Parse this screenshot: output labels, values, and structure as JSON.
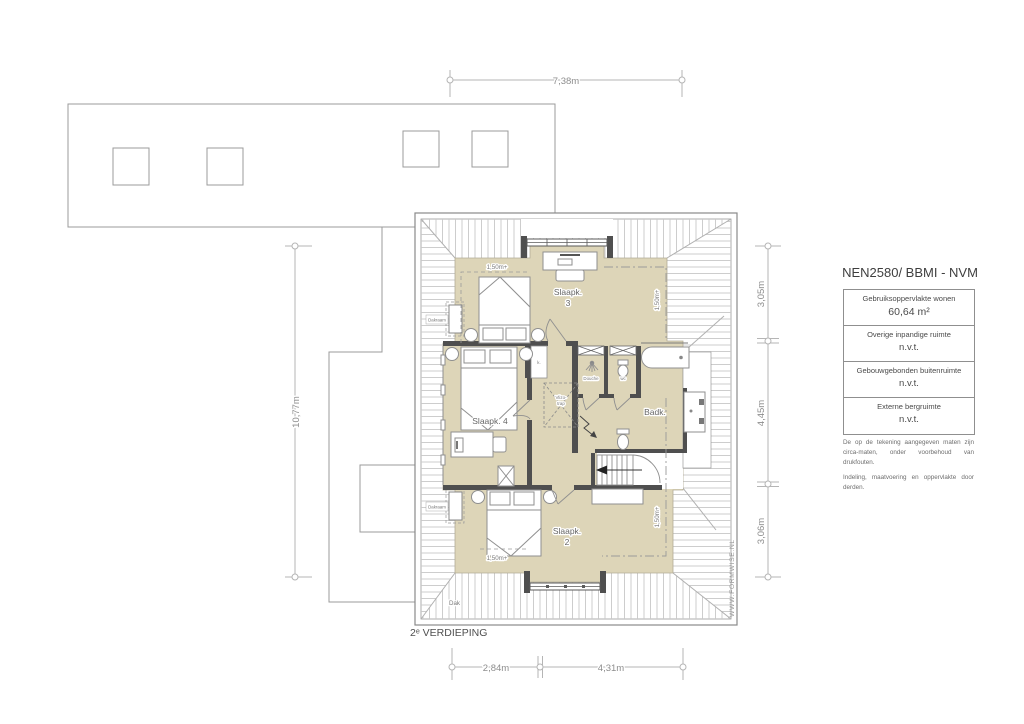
{
  "plan": {
    "floor_label": "2ᵉ VERDIEPING",
    "watermark": "WWW.FORMWISE.NL",
    "rooms": {
      "slaapk3": {
        "line1": "Slaapk.",
        "line2": "3"
      },
      "slaapk4": "Slaapk. 4",
      "slaapk2": {
        "line1": "Slaapk.",
        "line2": "2"
      },
      "badkamer": "Badk.",
      "douche": "Douche",
      "wc": "wc",
      "kast": "k.",
      "vlizotrap": {
        "line1": "Vlizo-",
        "line2": "trap"
      },
      "dak": "Dak",
      "dakraam_top": "Dakraam",
      "dakraam_bottom": "Dakraam"
    },
    "headroom": {
      "slaapk3": "1,50m+",
      "slaapk2": "1,50m+",
      "right_top": "1,50m+",
      "right_bottom": "1,50m+"
    }
  },
  "dimensions": {
    "top_width": "7,38m",
    "left_height": "10,77m",
    "right": {
      "top": "3,05m",
      "middle": "4,45m",
      "bottom": "3,06m"
    },
    "bottom": {
      "left": "2,84m",
      "right": "4,31m"
    }
  },
  "legend": {
    "title": "NEN2580/ BBMI - NVM",
    "rows": [
      {
        "label": "Gebruiksoppervlakte wonen",
        "value": "60,64 m²"
      },
      {
        "label": "Overige inpandige ruimte",
        "value": "n.v.t."
      },
      {
        "label": "Gebouwgebonden buitenruimte",
        "value": "n.v.t."
      },
      {
        "label": "Externe bergruimte",
        "value": "n.v.t."
      }
    ],
    "disclaimer_1": "De op de tekening aangegeven maten zijn circa-maten, onder voorbehoud van drukfouten.",
    "disclaimer_2": "Indeling, maatvoering en oppervlakte door derden."
  },
  "colors": {
    "floor_fill": "#DDD5B8",
    "wall": "#4F4F4F",
    "outline": "#8F8F8F",
    "hatch": "#C8C8C8",
    "dimension_line": "#B5B5B5",
    "text": "#5A5A5A"
  }
}
